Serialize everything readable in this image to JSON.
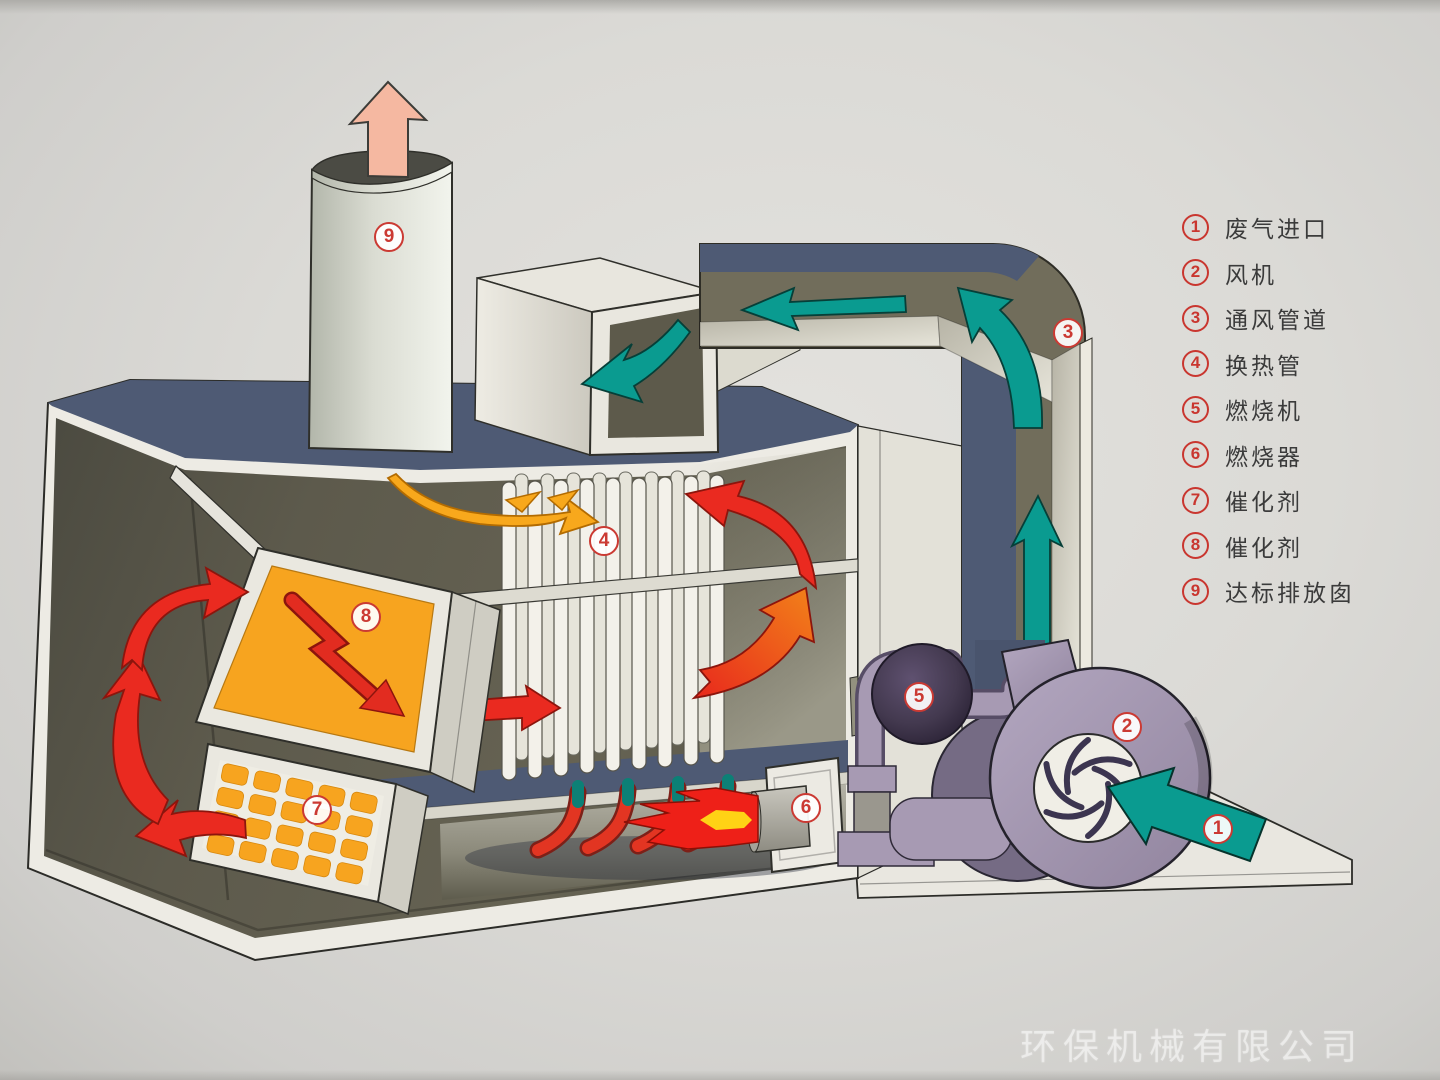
{
  "legend": {
    "items": [
      {
        "num": "1",
        "label": "废气进口"
      },
      {
        "num": "2",
        "label": "风机"
      },
      {
        "num": "3",
        "label": "通风管道"
      },
      {
        "num": "4",
        "label": "换热管"
      },
      {
        "num": "5",
        "label": "燃烧机"
      },
      {
        "num": "6",
        "label": "燃烧器"
      },
      {
        "num": "7",
        "label": "催化剂"
      },
      {
        "num": "8",
        "label": "催化剂"
      },
      {
        "num": "9",
        "label": "达标排放囱"
      }
    ]
  },
  "callouts": [
    {
      "num": "1"
    },
    {
      "num": "2"
    },
    {
      "num": "3"
    },
    {
      "num": "4"
    },
    {
      "num": "5"
    },
    {
      "num": "6"
    },
    {
      "num": "7"
    },
    {
      "num": "8"
    },
    {
      "num": "9"
    }
  ],
  "watermark": {
    "text": "环保机械有限公司"
  },
  "colors": {
    "teal": "#0a9b90",
    "red": "#ea2a20",
    "orange_panel": "#f7a41f",
    "yellow_arrow": "#f8a81c",
    "navy": "#4e5a74",
    "olive_interior": "#5f5c4e",
    "olive_duct": "#716d5b",
    "lavender": "#a79ab3",
    "salmon": "#f5b8a1",
    "flame_core": "#ffd215",
    "badge_ring": "#cb3a33",
    "legend_text": "#3b3b3b"
  }
}
